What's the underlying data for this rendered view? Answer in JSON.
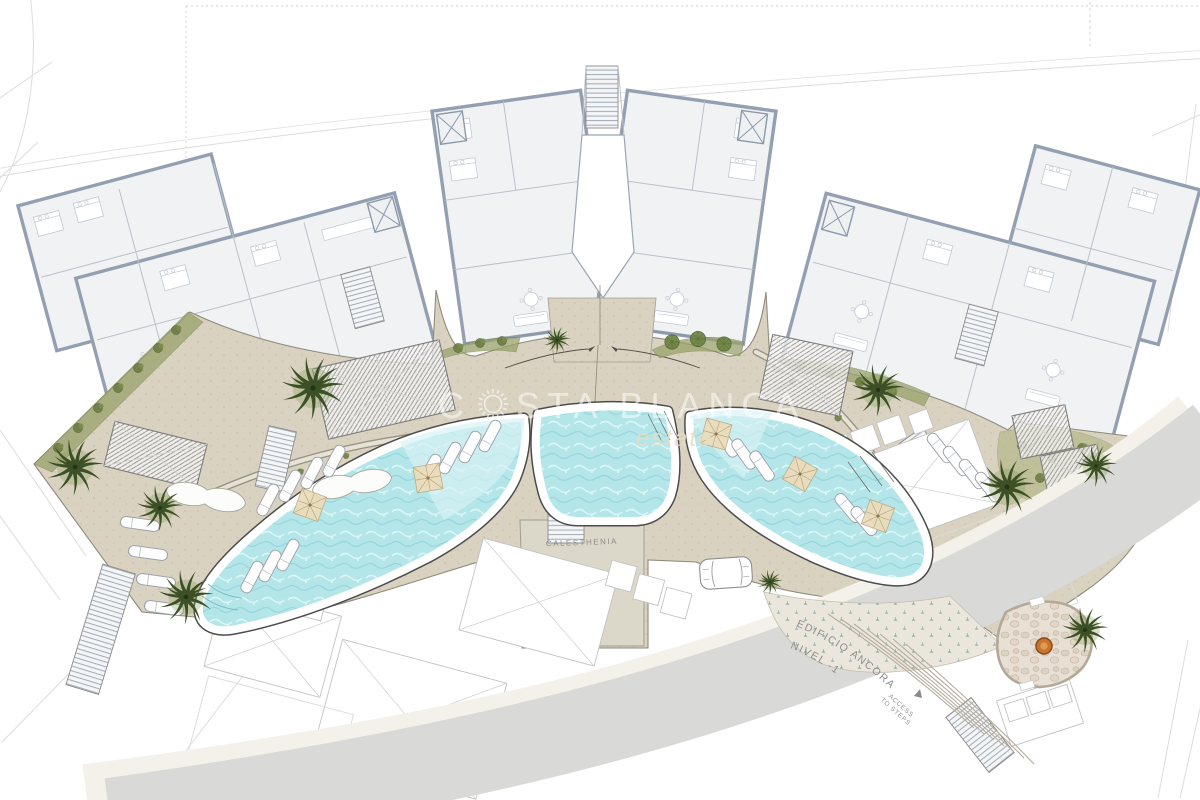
{
  "plan": {
    "watermark": {
      "prefix": "C",
      "suffix": "STA BLANCA",
      "tagline": "estate",
      "icon": "sun-icon"
    },
    "labels": {
      "calisthenics_area": "CALESTHENIA",
      "building_name": "EDIFICIO ANCORA",
      "level": "NIVEL -1",
      "access_line1": "ACCESS",
      "access_line2": "TO STEPS"
    },
    "colors": {
      "pool_water": "#b4e6e9",
      "deck_beige": "#d9d2c0",
      "wall_blue_gray": "#94a0b1",
      "vegetation_green": "#3c5026",
      "road_gray": "#d9d9d8",
      "fire_pit_orange": "#c9742e",
      "watermark_white": "#ffffff",
      "tagline_sand": "#e6ddc2"
    },
    "icons": [
      "sun-icon",
      "palm-tree-icon",
      "round-tree-icon",
      "shrub-icon",
      "parasol-icon",
      "sun-lounger-icon",
      "daybed-icon",
      "fire-pit-icon",
      "stairs-icon",
      "elevator-icon",
      "car-icon"
    ]
  }
}
